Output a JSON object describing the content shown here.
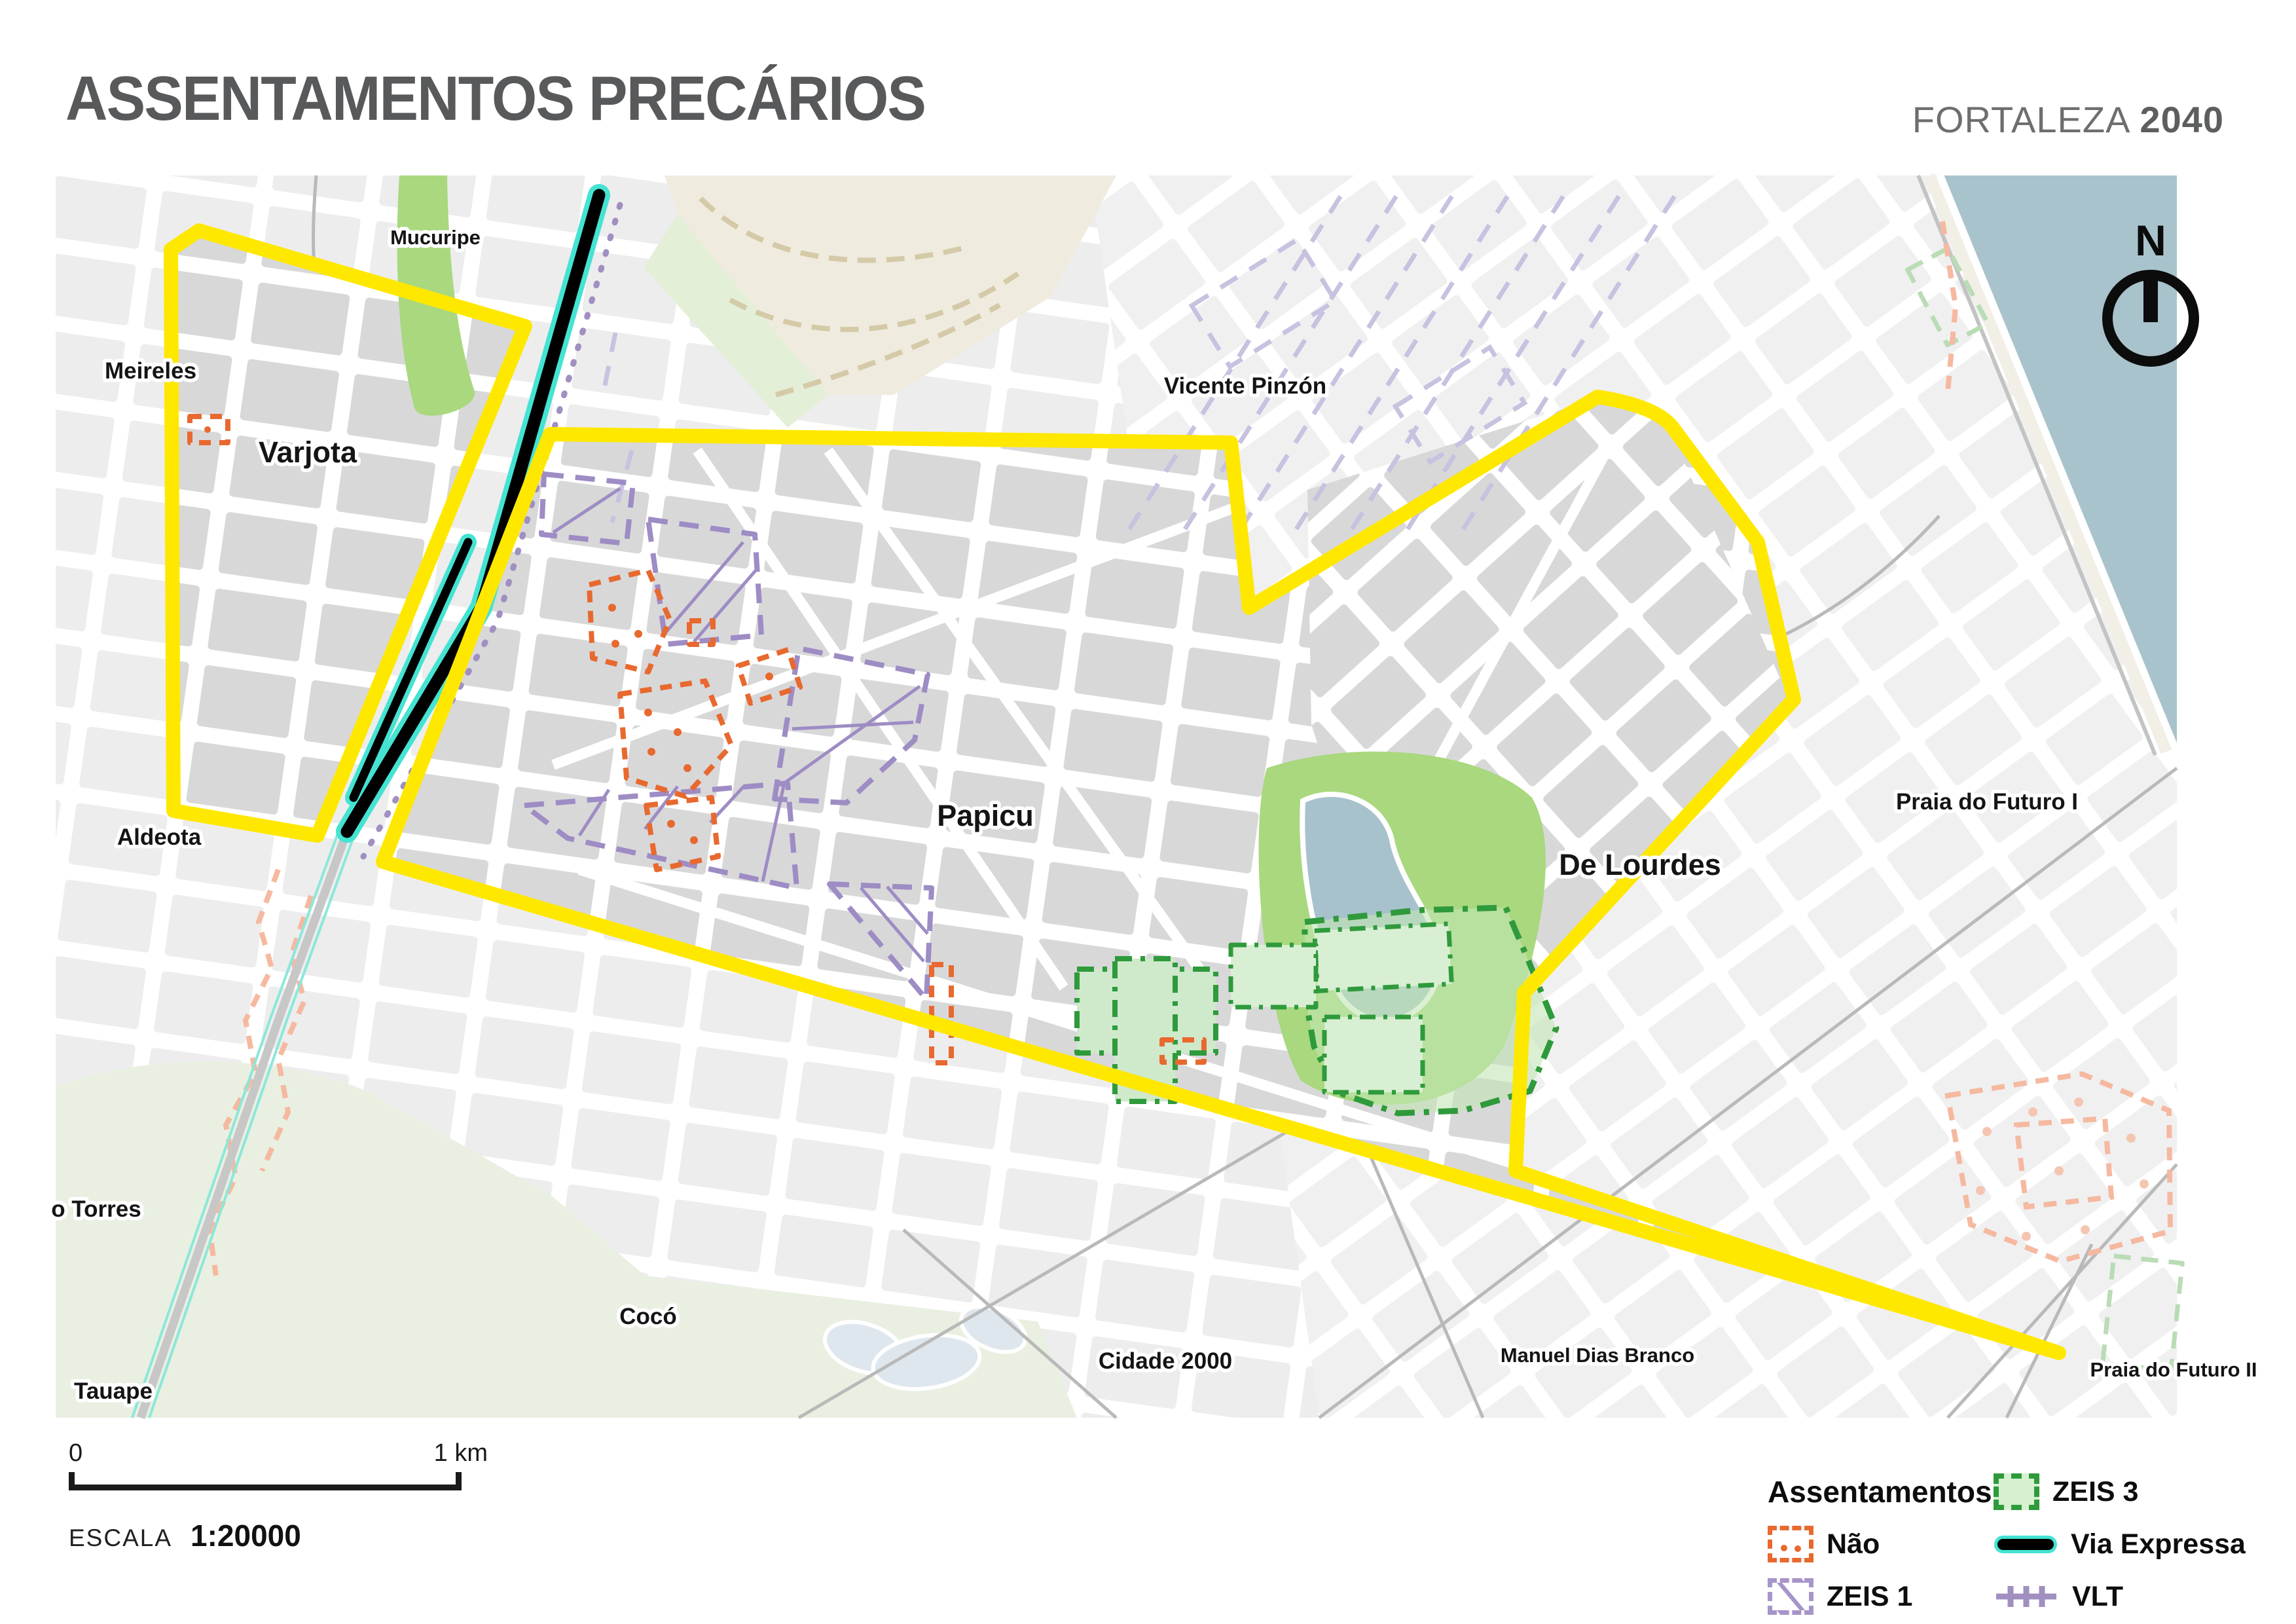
{
  "title": "ASSENTAMENTOS PRECÁRIOS",
  "brand": {
    "city": "FORTALEZA",
    "year": "2040"
  },
  "north_label": "N",
  "map": {
    "labels": [
      {
        "id": "mucuripe",
        "text": "Mucuripe"
      },
      {
        "id": "meireles",
        "text": "Meireles"
      },
      {
        "id": "varjota",
        "text": "Varjota"
      },
      {
        "id": "vicente-pinzon",
        "text": "Vicente Pinzón"
      },
      {
        "id": "papicu",
        "text": "Papicu"
      },
      {
        "id": "de-lourdes",
        "text": "De Lourdes"
      },
      {
        "id": "praia-do-futuro-1",
        "text": "Praia do Futuro I"
      },
      {
        "id": "aldeota",
        "text": "Aldeota"
      },
      {
        "id": "dionisio-torres",
        "text": "o Torres"
      },
      {
        "id": "coco",
        "text": "Cocó"
      },
      {
        "id": "cidade-2000",
        "text": "Cidade 2000"
      },
      {
        "id": "manuel-dias-branco",
        "text": "Manuel Dias Branco"
      },
      {
        "id": "praia-do-futuro-2",
        "text": "Praia do Futuro II"
      },
      {
        "id": "tauape",
        "text": "Tauape"
      }
    ],
    "colors": {
      "boundary_yellow": "#ffe800",
      "via_expressa_black": "#000000",
      "via_expressa_glow": "#44e3d2",
      "vlt_purple": "#a08fc0",
      "zeis1_purple": "#a795c9",
      "zeis3_green": "#2f9a3c",
      "zeis3_fill": "#d6f0d0",
      "nao_orange": "#e8692f",
      "nao_faded": "#f5b9a0",
      "park_green": "#a9d87e",
      "water_blue": "#a9c3cc",
      "blocks_inside": "#d8d8d9",
      "blocks_outside": "#ededee"
    }
  },
  "scale": {
    "start": "0",
    "end": "1 km",
    "label": "ESCALA",
    "ratio": "1:20000"
  },
  "legend": {
    "header": "Assentamentos",
    "items": [
      {
        "id": "nao",
        "label": "Não"
      },
      {
        "id": "zeis1",
        "label": "ZEIS 1"
      },
      {
        "id": "zeis3",
        "label": "ZEIS 3"
      },
      {
        "id": "via-expressa",
        "label": "Via Expressa"
      },
      {
        "id": "vlt",
        "label": "VLT"
      }
    ]
  }
}
